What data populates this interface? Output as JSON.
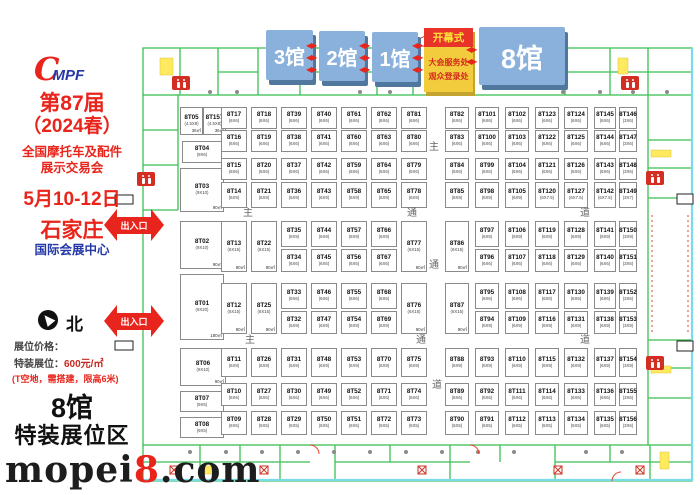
{
  "sidebar": {
    "logo_c": "C",
    "logo_text": "MPF",
    "title1": "第87届",
    "title2": "（2024春）",
    "title3": "全国摩托车及配件",
    "title4": "展示交易会",
    "date": "5月10-12日",
    "city": "石家庄",
    "venue": "国际会展中心",
    "north": "北",
    "price_heading": "展位价格：",
    "price_label": "特装展位：",
    "price_value": "600元/㎡",
    "price_note": "(T空地，需搭建，限高6米)",
    "hall_big": "8馆",
    "hall_zone": "特装展位区",
    "watermark_pre": "mopei",
    "watermark_num": "8",
    "watermark_post": ".com"
  },
  "halls": [
    {
      "label": "3馆"
    },
    {
      "label": "2馆"
    },
    {
      "label": "1馆"
    },
    {
      "label": "8馆"
    }
  ],
  "opening": {
    "header": "开幕式",
    "line1": "大会服务处",
    "line2": "观众登录处"
  },
  "entrances": [
    {
      "label": "出入口"
    },
    {
      "label": "出入口"
    }
  ],
  "arrow_glyph": "◀▶",
  "colors": {
    "accent_red": "#e8241b",
    "hall_blue": "#89b1dc",
    "opening_yellow": "#f2cc3d",
    "wall_green": "#3bbf52"
  },
  "aisle_labels": [
    {
      "text": "主",
      "x": 243,
      "y": 204
    },
    {
      "text": "通",
      "x": 407,
      "y": 204
    },
    {
      "text": "道",
      "x": 580,
      "y": 204
    },
    {
      "text": "主",
      "x": 429,
      "y": 138
    },
    {
      "text": "通",
      "x": 429,
      "y": 256
    },
    {
      "text": "道",
      "x": 432,
      "y": 376
    },
    {
      "text": "主",
      "x": 245,
      "y": 331
    },
    {
      "text": "通",
      "x": 416,
      "y": 331
    },
    {
      "text": "道",
      "x": 580,
      "y": 331
    }
  ],
  "facilities": {
    "restroom_icon": "restroom-icon",
    "restrooms": [
      [
        172,
        76
      ],
      [
        621,
        76
      ],
      [
        137,
        172
      ],
      [
        646,
        171
      ],
      [
        646,
        356
      ]
    ]
  },
  "grid": {
    "default_size": "(6X6)",
    "cols": {
      "B": [
        221,
        26
      ],
      "C": [
        251,
        26
      ],
      "D": [
        281,
        26
      ],
      "E": [
        311,
        26
      ],
      "F": [
        341,
        26
      ],
      "G": [
        371,
        26
      ],
      "H": [
        401,
        26
      ],
      "I": [
        445,
        24
      ],
      "J": [
        475,
        24
      ],
      "K": [
        505,
        24
      ],
      "L": [
        535,
        24
      ],
      "M": [
        564,
        24
      ],
      "N": [
        594,
        22
      ],
      "O": [
        619,
        18
      ]
    },
    "rows": {
      "R1": [
        107,
        22
      ],
      "R2": [
        130,
        22
      ],
      "R3": [
        158,
        22
      ],
      "R4": [
        182,
        26
      ],
      "R5a": [
        221,
        26
      ],
      "R5b": [
        249,
        23
      ],
      "R6a": [
        283,
        26
      ],
      "R6b": [
        311,
        23
      ],
      "R7": [
        348,
        29
      ],
      "R8": [
        383,
        23
      ],
      "R9": [
        411,
        24
      ],
      "T5": [
        221,
        51
      ],
      "T6": [
        283,
        51
      ]
    },
    "booths": [
      {
        "id": "8T05",
        "s": "(4.5X8)",
        "a": "36㎡",
        "r": [
          180,
          107,
          23,
          28
        ]
      },
      {
        "id": "8T157",
        "s": "(4.5X8)",
        "a": "36㎡",
        "r": [
          203,
          107,
          23,
          28
        ]
      },
      {
        "id": "8T04",
        "s": "(9X6)",
        "r": [
          182,
          141,
          40,
          22
        ]
      },
      {
        "id": "8T03",
        "s": "(9X10)",
        "a": "90㎡",
        "r": [
          180,
          168,
          44,
          44
        ]
      },
      {
        "id": "8T02",
        "s": "(9X10)",
        "a": "90㎡",
        "r": [
          180,
          221,
          44,
          48
        ]
      },
      {
        "id": "8T01",
        "s": "(9X20)",
        "a": "180㎡",
        "r": [
          180,
          274,
          44,
          66
        ]
      },
      {
        "id": "8T06",
        "s": "(9X10)",
        "a": "90㎡",
        "r": [
          180,
          348,
          46,
          38
        ]
      },
      {
        "id": "8T07",
        "s": "(9X5)",
        "r": [
          180,
          391,
          44,
          21
        ]
      },
      {
        "id": "8T08",
        "s": "(9X5)",
        "r": [
          180,
          417,
          44,
          21
        ]
      },
      {
        "id": "8T17",
        "c": "B",
        "w": "R1"
      },
      {
        "id": "8T16",
        "c": "B",
        "w": "R2"
      },
      {
        "id": "8T15",
        "c": "B",
        "w": "R3"
      },
      {
        "id": "8T14",
        "s": "(6X9)",
        "c": "B",
        "w": "R4"
      },
      {
        "id": "8T13",
        "s": "(6X15)",
        "a": "90㎡",
        "c": "B",
        "w": "T5"
      },
      {
        "id": "8T12",
        "s": "(6X15)",
        "a": "90㎡",
        "c": "B",
        "w": "T6"
      },
      {
        "id": "8T11",
        "s": "(6X9)",
        "c": "B",
        "w": "R7"
      },
      {
        "id": "8T10",
        "c": "B",
        "w": "R8"
      },
      {
        "id": "8T09",
        "s": "(6X5)",
        "c": "B",
        "w": "R9"
      },
      {
        "id": "8T18",
        "c": "C",
        "w": "R1"
      },
      {
        "id": "8T19",
        "c": "C",
        "w": "R2"
      },
      {
        "id": "8T20",
        "c": "C",
        "w": "R3"
      },
      {
        "id": "8T21",
        "s": "(6X9)",
        "c": "C",
        "w": "R4"
      },
      {
        "id": "8T22",
        "s": "(6X15)",
        "a": "90㎡",
        "c": "C",
        "w": "T5"
      },
      {
        "id": "8T25",
        "s": "(6X15)",
        "a": "90㎡",
        "c": "C",
        "w": "T6"
      },
      {
        "id": "8T26",
        "s": "(6X9)",
        "c": "C",
        "w": "R7"
      },
      {
        "id": "8T27",
        "c": "C",
        "w": "R8"
      },
      {
        "id": "8T28",
        "s": "(6X5)",
        "c": "C",
        "w": "R9"
      },
      {
        "id": "8T39",
        "c": "D",
        "w": "R1"
      },
      {
        "id": "8T38",
        "c": "D",
        "w": "R2"
      },
      {
        "id": "8T37",
        "c": "D",
        "w": "R3"
      },
      {
        "id": "8T36",
        "s": "(6X9)",
        "c": "D",
        "w": "R4"
      },
      {
        "id": "8T35",
        "s": "(6X9)",
        "c": "D",
        "w": "R5a"
      },
      {
        "id": "8T34",
        "c": "D",
        "w": "R5b"
      },
      {
        "id": "8T33",
        "c": "D",
        "w": "R6a"
      },
      {
        "id": "8T32",
        "s": "(6X9)",
        "c": "D",
        "w": "R6b"
      },
      {
        "id": "8T31",
        "s": "(6X9)",
        "c": "D",
        "w": "R7"
      },
      {
        "id": "8T30",
        "c": "D",
        "w": "R8"
      },
      {
        "id": "8T29",
        "s": "(6X5)",
        "c": "D",
        "w": "R9"
      },
      {
        "id": "8T40",
        "c": "E",
        "w": "R1"
      },
      {
        "id": "8T41",
        "c": "E",
        "w": "R2"
      },
      {
        "id": "8T42",
        "c": "E",
        "w": "R3"
      },
      {
        "id": "8T43",
        "s": "(6X9)",
        "c": "E",
        "w": "R4"
      },
      {
        "id": "8T44",
        "s": "(6X9)",
        "c": "E",
        "w": "R5a"
      },
      {
        "id": "8T45",
        "c": "E",
        "w": "R5b"
      },
      {
        "id": "8T46",
        "c": "E",
        "w": "R6a"
      },
      {
        "id": "8T47",
        "s": "(6X9)",
        "c": "E",
        "w": "R6b"
      },
      {
        "id": "8T48",
        "s": "(6X9)",
        "c": "E",
        "w": "R7"
      },
      {
        "id": "8T49",
        "c": "E",
        "w": "R8"
      },
      {
        "id": "8T50",
        "s": "(6X5)",
        "c": "E",
        "w": "R9"
      },
      {
        "id": "8T61",
        "c": "F",
        "w": "R1"
      },
      {
        "id": "8T60",
        "c": "F",
        "w": "R2"
      },
      {
        "id": "8T59",
        "c": "F",
        "w": "R3"
      },
      {
        "id": "8T58",
        "s": "(6X9)",
        "c": "F",
        "w": "R4"
      },
      {
        "id": "8T57",
        "s": "(6X9)",
        "c": "F",
        "w": "R5a"
      },
      {
        "id": "8T56",
        "c": "F",
        "w": "R5b"
      },
      {
        "id": "8T55",
        "c": "F",
        "w": "R6a"
      },
      {
        "id": "8T54",
        "s": "(6X9)",
        "c": "F",
        "w": "R6b"
      },
      {
        "id": "8T53",
        "s": "(6X9)",
        "c": "F",
        "w": "R7"
      },
      {
        "id": "8T52",
        "c": "F",
        "w": "R8"
      },
      {
        "id": "8T51",
        "s": "(6X5)",
        "c": "F",
        "w": "R9"
      },
      {
        "id": "8T62",
        "c": "G",
        "w": "R1"
      },
      {
        "id": "8T63",
        "c": "G",
        "w": "R2"
      },
      {
        "id": "8T64",
        "c": "G",
        "w": "R3"
      },
      {
        "id": "8T65",
        "s": "(6X9)",
        "c": "G",
        "w": "R4"
      },
      {
        "id": "8T66",
        "s": "(6X9)",
        "c": "G",
        "w": "R5a"
      },
      {
        "id": "8T67",
        "c": "G",
        "w": "R5b"
      },
      {
        "id": "8T68",
        "c": "G",
        "w": "R6a"
      },
      {
        "id": "8T69",
        "s": "(6X9)",
        "c": "G",
        "w": "R6b"
      },
      {
        "id": "8T70",
        "s": "(6X9)",
        "c": "G",
        "w": "R7"
      },
      {
        "id": "8T71",
        "c": "G",
        "w": "R8"
      },
      {
        "id": "8T72",
        "s": "(6X5)",
        "c": "G",
        "w": "R9"
      },
      {
        "id": "8T81",
        "c": "H",
        "w": "R1"
      },
      {
        "id": "8T80",
        "c": "H",
        "w": "R2"
      },
      {
        "id": "8T79",
        "c": "H",
        "w": "R3"
      },
      {
        "id": "8T78",
        "s": "(6X9)",
        "c": "H",
        "w": "R4"
      },
      {
        "id": "8T77",
        "s": "(6X15)",
        "a": "90㎡",
        "c": "H",
        "w": "T5"
      },
      {
        "id": "8T76",
        "s": "(6X15)",
        "a": "90㎡",
        "c": "H",
        "w": "T6"
      },
      {
        "id": "8T75",
        "s": "(6X9)",
        "c": "H",
        "w": "R7"
      },
      {
        "id": "8T74",
        "c": "H",
        "w": "R8"
      },
      {
        "id": "8T73",
        "s": "(6X5)",
        "c": "H",
        "w": "R9"
      },
      {
        "id": "8T82",
        "c": "I",
        "w": "R1"
      },
      {
        "id": "8T83",
        "c": "I",
        "w": "R2"
      },
      {
        "id": "8T84",
        "c": "I",
        "w": "R3"
      },
      {
        "id": "8T85",
        "s": "(6X9)",
        "c": "I",
        "w": "R4"
      },
      {
        "id": "8T86",
        "s": "(6X15)",
        "a": "90㎡",
        "c": "I",
        "w": "T5"
      },
      {
        "id": "8T87",
        "s": "(6X15)",
        "a": "90㎡",
        "c": "I",
        "w": "T6"
      },
      {
        "id": "8T88",
        "s": "(6X9)",
        "c": "I",
        "w": "R7"
      },
      {
        "id": "8T89",
        "c": "I",
        "w": "R8"
      },
      {
        "id": "8T90",
        "s": "(6X5)",
        "c": "I",
        "w": "R9"
      },
      {
        "id": "8T101",
        "c": "J",
        "w": "R1"
      },
      {
        "id": "8T100",
        "c": "J",
        "w": "R2"
      },
      {
        "id": "8T99",
        "c": "J",
        "w": "R3"
      },
      {
        "id": "8T98",
        "s": "(6X9)",
        "c": "J",
        "w": "R4"
      },
      {
        "id": "8T97",
        "s": "(6X9)",
        "c": "J",
        "w": "R5a"
      },
      {
        "id": "8T96",
        "c": "J",
        "w": "R5b"
      },
      {
        "id": "8T95",
        "c": "J",
        "w": "R6a"
      },
      {
        "id": "8T94",
        "s": "(6X9)",
        "c": "J",
        "w": "R6b"
      },
      {
        "id": "8T93",
        "s": "(6X9)",
        "c": "J",
        "w": "R7"
      },
      {
        "id": "8T92",
        "c": "J",
        "w": "R8"
      },
      {
        "id": "8T91",
        "s": "(6X5)",
        "c": "J",
        "w": "R9"
      },
      {
        "id": "8T102",
        "c": "K",
        "w": "R1"
      },
      {
        "id": "8T103",
        "c": "K",
        "w": "R2"
      },
      {
        "id": "8T104",
        "c": "K",
        "w": "R3"
      },
      {
        "id": "8T105",
        "s": "(6X9)",
        "c": "K",
        "w": "R4"
      },
      {
        "id": "8T106",
        "s": "(6X9)",
        "c": "K",
        "w": "R5a"
      },
      {
        "id": "8T107",
        "c": "K",
        "w": "R5b"
      },
      {
        "id": "8T108",
        "c": "K",
        "w": "R6a"
      },
      {
        "id": "8T109",
        "s": "(6X9)",
        "c": "K",
        "w": "R6b"
      },
      {
        "id": "8T110",
        "s": "(6X9)",
        "c": "K",
        "w": "R7"
      },
      {
        "id": "8T111",
        "c": "K",
        "w": "R8"
      },
      {
        "id": "8T112",
        "s": "(6X5)",
        "c": "K",
        "w": "R9"
      },
      {
        "id": "8T123",
        "c": "L",
        "w": "R1"
      },
      {
        "id": "8T122",
        "c": "L",
        "w": "R2"
      },
      {
        "id": "8T121",
        "c": "L",
        "w": "R3"
      },
      {
        "id": "8T120",
        "s": "(6X7.5)",
        "c": "L",
        "w": "R4"
      },
      {
        "id": "8T119",
        "s": "(6X9)",
        "c": "L",
        "w": "R5a"
      },
      {
        "id": "8T118",
        "c": "L",
        "w": "R5b"
      },
      {
        "id": "8T117",
        "c": "L",
        "w": "R6a"
      },
      {
        "id": "8T116",
        "s": "(6X9)",
        "c": "L",
        "w": "R6b"
      },
      {
        "id": "8T115",
        "s": "(6X9)",
        "c": "L",
        "w": "R7"
      },
      {
        "id": "8T114",
        "c": "L",
        "w": "R8"
      },
      {
        "id": "8T113",
        "s": "(6X5)",
        "c": "L",
        "w": "R9"
      },
      {
        "id": "8T124",
        "c": "M",
        "w": "R1"
      },
      {
        "id": "8T125",
        "c": "M",
        "w": "R2"
      },
      {
        "id": "8T126",
        "c": "M",
        "w": "R3"
      },
      {
        "id": "8T127",
        "s": "(6X7.5)",
        "c": "M",
        "w": "R4"
      },
      {
        "id": "8T128",
        "s": "(6X9)",
        "c": "M",
        "w": "R5a"
      },
      {
        "id": "8T129",
        "c": "M",
        "w": "R5b"
      },
      {
        "id": "8T130",
        "c": "M",
        "w": "R6a"
      },
      {
        "id": "8T131",
        "s": "(6X9)",
        "c": "M",
        "w": "R6b"
      },
      {
        "id": "8T132",
        "s": "(6X9)",
        "c": "M",
        "w": "R7"
      },
      {
        "id": "8T133",
        "c": "M",
        "w": "R8"
      },
      {
        "id": "8T134",
        "s": "(6X5)",
        "c": "M",
        "w": "R9"
      },
      {
        "id": "8T145",
        "c": "N",
        "w": "R1"
      },
      {
        "id": "8T144",
        "c": "N",
        "w": "R2"
      },
      {
        "id": "8T143",
        "c": "N",
        "w": "R3"
      },
      {
        "id": "8T142",
        "s": "(6X7.5)",
        "c": "N",
        "w": "R4"
      },
      {
        "id": "8T141",
        "s": "(6X9)",
        "c": "N",
        "w": "R5a"
      },
      {
        "id": "8T140",
        "c": "N",
        "w": "R5b"
      },
      {
        "id": "8T139",
        "c": "N",
        "w": "R6a"
      },
      {
        "id": "8T138",
        "s": "(6X9)",
        "c": "N",
        "w": "R6b"
      },
      {
        "id": "8T137",
        "s": "(6X9)",
        "c": "N",
        "w": "R7"
      },
      {
        "id": "8T136",
        "c": "N",
        "w": "R8"
      },
      {
        "id": "8T135",
        "s": "(6X5)",
        "c": "N",
        "w": "R9"
      },
      {
        "id": "8T146",
        "s": "(3X6)",
        "c": "O",
        "w": "R1"
      },
      {
        "id": "8T147",
        "s": "(3X6)",
        "c": "O",
        "w": "R2"
      },
      {
        "id": "8T148",
        "s": "(3X6)",
        "c": "O",
        "w": "R3"
      },
      {
        "id": "8T149",
        "s": "(3X7)",
        "c": "O",
        "w": "R4"
      },
      {
        "id": "8T150",
        "s": "(3X9)",
        "c": "O",
        "w": "R5a"
      },
      {
        "id": "8T151",
        "s": "(3X6)",
        "c": "O",
        "w": "R5b"
      },
      {
        "id": "8T152",
        "s": "(3X6)",
        "c": "O",
        "w": "R6a"
      },
      {
        "id": "8T153",
        "s": "(3X9)",
        "c": "O",
        "w": "R6b"
      },
      {
        "id": "8T154",
        "s": "(3X9)",
        "c": "O",
        "w": "R7"
      },
      {
        "id": "8T155",
        "s": "(3X6)",
        "c": "O",
        "w": "R8"
      },
      {
        "id": "8T156",
        "s": "(3X6)",
        "c": "O",
        "w": "R9"
      }
    ]
  }
}
